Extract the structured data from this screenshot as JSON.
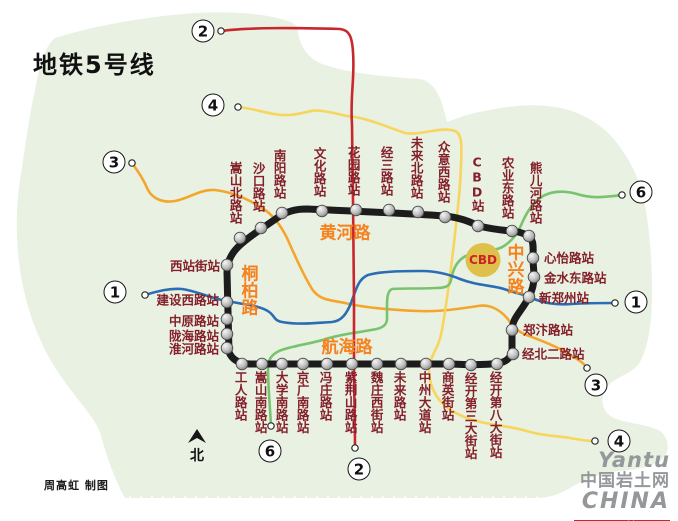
{
  "title": "地铁5号线",
  "credit": "周高虹 制图",
  "north": {
    "label": "北"
  },
  "cbd": {
    "label": "CBD"
  },
  "roads": {
    "huanghe": "黄河路",
    "hanghai": "航海路",
    "tongbai": "桐柏路",
    "zhongxing": "中兴路"
  },
  "logo": {
    "word1": "Yantu",
    "word2": "中国岩土网",
    "word3": "CHINA",
    "url": "www.yantuchina.com"
  },
  "colors": {
    "map_bg": "#e9f1e2",
    "loop": "#1c1c1c",
    "line1_blue": "#2a6db5",
    "line2_red": "#c9272e",
    "line3_orange": "#f4a62c",
    "line4_yellow": "#f8d55e",
    "line6_green": "#79c36e",
    "station_text": "#84202a",
    "road_text": "#f5821f",
    "cbd_fill": "#dec04a",
    "cbd_text": "#cc2328",
    "logo_gray": "#95989a",
    "logo_red": "#c9272e"
  },
  "stations": [
    {
      "name": "文化路站",
      "bx": 322,
      "by": 211,
      "lx": 319,
      "ly": 197,
      "mode": "vup"
    },
    {
      "name": "花园路站",
      "bx": 356,
      "by": 210,
      "lx": 353,
      "ly": 196,
      "mode": "vup"
    },
    {
      "name": "经三路站",
      "bx": 389,
      "by": 210,
      "lx": 386,
      "ly": 196,
      "mode": "vup"
    },
    {
      "name": "未来北路站",
      "bx": 418,
      "by": 212,
      "lx": 416,
      "ly": 199,
      "mode": "vup"
    },
    {
      "name": "众意西路站",
      "bx": 445,
      "by": 217,
      "lx": 443,
      "ly": 203,
      "mode": "vup"
    },
    {
      "name": "CBD站",
      "bx": 478,
      "by": 226,
      "lx": 477,
      "ly": 212,
      "mode": "vup"
    },
    {
      "name": "农业东路站",
      "bx": 512,
      "by": 231,
      "lx": 507,
      "ly": 219,
      "mode": "vup"
    },
    {
      "name": "熊儿河路站",
      "bx": 529,
      "by": 236,
      "lx": 535,
      "ly": 224,
      "mode": "vup"
    },
    {
      "name": "南阳路站",
      "bx": 282,
      "by": 213,
      "lx": 279,
      "ly": 199,
      "mode": "vup"
    },
    {
      "name": "沙口路站",
      "bx": 261,
      "by": 228,
      "lx": 258,
      "ly": 212,
      "mode": "vup"
    },
    {
      "name": "嵩山北路站",
      "bx": 240,
      "by": 238,
      "lx": 235,
      "ly": 224,
      "mode": "vup"
    },
    {
      "name": "工人路站",
      "bx": 242,
      "by": 364,
      "lx": 240,
      "ly": 371,
      "mode": "vdown"
    },
    {
      "name": "嵩山南路站",
      "bx": 262,
      "by": 364,
      "lx": 260,
      "ly": 371,
      "mode": "vdown"
    },
    {
      "name": "大学南路站",
      "bx": 282,
      "by": 364,
      "lx": 281,
      "ly": 371,
      "mode": "vdown"
    },
    {
      "name": "京广南路站",
      "bx": 303,
      "by": 364,
      "lx": 302,
      "ly": 371,
      "mode": "vdown"
    },
    {
      "name": "冯庄路站",
      "bx": 327,
      "by": 364,
      "lx": 325,
      "ly": 371,
      "mode": "vdown"
    },
    {
      "name": "紫荆山路站",
      "bx": 352,
      "by": 364,
      "lx": 350,
      "ly": 371,
      "mode": "vdown"
    },
    {
      "name": "魏庄西街站",
      "bx": 377,
      "by": 364,
      "lx": 376,
      "ly": 371,
      "mode": "vdown"
    },
    {
      "name": "未来路站",
      "bx": 401,
      "by": 364,
      "lx": 399,
      "ly": 371,
      "mode": "vdown"
    },
    {
      "name": "中州大道站",
      "bx": 426,
      "by": 364,
      "lx": 424,
      "ly": 371,
      "mode": "vdown"
    },
    {
      "name": "商英街站",
      "bx": 449,
      "by": 364,
      "lx": 447,
      "ly": 371,
      "mode": "vdown"
    },
    {
      "name": "经开第三大街站",
      "bx": 471,
      "by": 365,
      "lx": 470,
      "ly": 372,
      "mode": "vdown"
    },
    {
      "name": "经开第八大街站",
      "bx": 497,
      "by": 364,
      "lx": 495,
      "ly": 371,
      "mode": "vdown"
    },
    {
      "name": "西站街站",
      "bx": 227,
      "by": 265,
      "lx": 220,
      "ly": 266,
      "mode": "hleft"
    },
    {
      "name": "建设西路站",
      "bx": 227,
      "by": 302,
      "lx": 219,
      "ly": 300,
      "mode": "hleft"
    },
    {
      "name": "中原路站",
      "bx": 227,
      "by": 319,
      "lx": 219,
      "ly": 321,
      "mode": "hleft"
    },
    {
      "name": "陇海路站",
      "bx": 227,
      "by": 334,
      "lx": 219,
      "ly": 336,
      "mode": "hleft"
    },
    {
      "name": "淮河路站",
      "bx": 227,
      "by": 348,
      "lx": 219,
      "ly": 349,
      "mode": "hleft"
    },
    {
      "name": "心怡路站",
      "bx": 533,
      "by": 258,
      "lx": 544,
      "ly": 258,
      "mode": "hright"
    },
    {
      "name": "金水东路站",
      "bx": 534,
      "by": 277,
      "lx": 544,
      "ly": 278,
      "mode": "hright"
    },
    {
      "name": "新郑州站",
      "bx": 529,
      "by": 297,
      "lx": 539,
      "ly": 298,
      "mode": "hright"
    },
    {
      "name": "郑汴路站",
      "bx": 512,
      "by": 330,
      "lx": 523,
      "ly": 330,
      "mode": "hright"
    },
    {
      "name": "经北二路站",
      "bx": 513,
      "by": 354,
      "lx": 522,
      "ly": 354,
      "mode": "hright"
    }
  ],
  "terminals": [
    {
      "line": "2",
      "x": 203,
      "y": 31,
      "dx": 221,
      "dy": 31
    },
    {
      "line": "4",
      "x": 213,
      "y": 105,
      "dx": 238,
      "dy": 107
    },
    {
      "line": "3",
      "x": 114,
      "y": 162,
      "dx": 132,
      "dy": 163
    },
    {
      "line": "1",
      "x": 115,
      "y": 292,
      "dx": 145,
      "dy": 295
    },
    {
      "line": "6",
      "x": 641,
      "y": 192,
      "dx": 622,
      "dy": 195
    },
    {
      "line": "1",
      "x": 636,
      "y": 302,
      "dx": 615,
      "dy": 303
    },
    {
      "line": "3",
      "x": 596,
      "y": 385,
      "dx": 587,
      "dy": 368
    },
    {
      "line": "4",
      "x": 619,
      "y": 441,
      "dx": 595,
      "dy": 441
    },
    {
      "line": "6",
      "x": 270,
      "y": 451,
      "dx": 271,
      "dy": 426
    },
    {
      "line": "2",
      "x": 359,
      "y": 469,
      "dx": 355,
      "dy": 448
    }
  ]
}
